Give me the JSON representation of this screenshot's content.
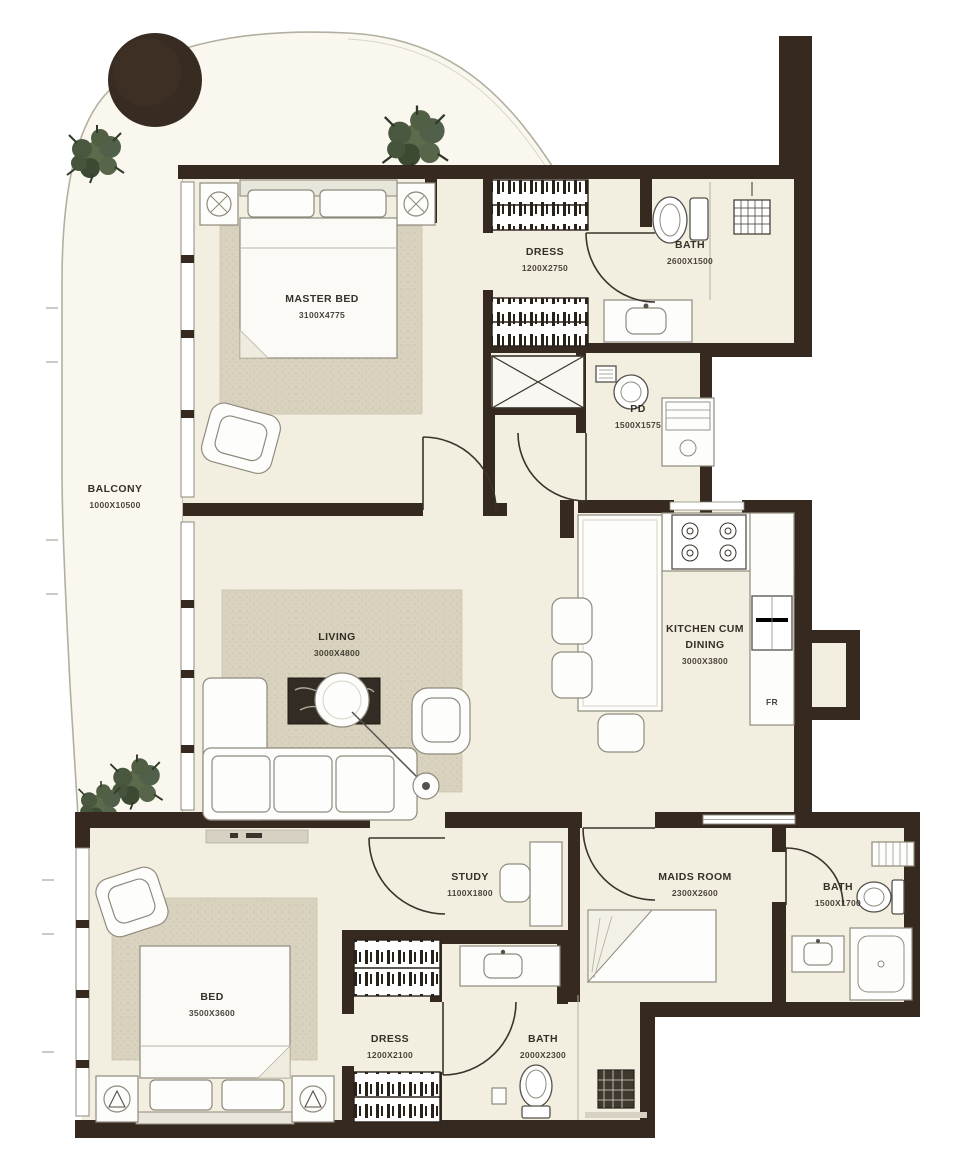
{
  "colors": {
    "wall": "#36291f",
    "floor": "#f3efe0",
    "balcony_floor": "#faf8ee",
    "rug": "#d8d2be",
    "plant": "#536244",
    "outline": "#b3afa0",
    "label_text": "#262019"
  },
  "rooms": {
    "balcony": {
      "name": "BALCONY",
      "dims": "1000X10500"
    },
    "master_bed": {
      "name": "MASTER BED",
      "dims": "3100X4775"
    },
    "dress_top": {
      "name": "DRESS",
      "dims": "1200X2750"
    },
    "bath_top": {
      "name": "BATH",
      "dims": "2600X1500"
    },
    "pd": {
      "name": "PD",
      "dims": "1500X1575"
    },
    "living": {
      "name": "LIVING",
      "dims": "3000X4800"
    },
    "kitchen": {
      "name": "KITCHEN CUM",
      "name2": "DINING",
      "dims": "3000X3800"
    },
    "study": {
      "name": "STUDY",
      "dims": "1100X1800"
    },
    "maids_room": {
      "name": "MAIDS ROOM",
      "dims": "2300X2600"
    },
    "bath_right": {
      "name": "BATH",
      "dims": "1500X1700"
    },
    "bed2": {
      "name": "BED",
      "dims": "3500X3600"
    },
    "dress2": {
      "name": "DRESS",
      "dims": "1200X2100"
    },
    "bath2": {
      "name": "BATH",
      "dims": "2000X2300"
    }
  },
  "appliances": {
    "fridge_label": "FR"
  }
}
